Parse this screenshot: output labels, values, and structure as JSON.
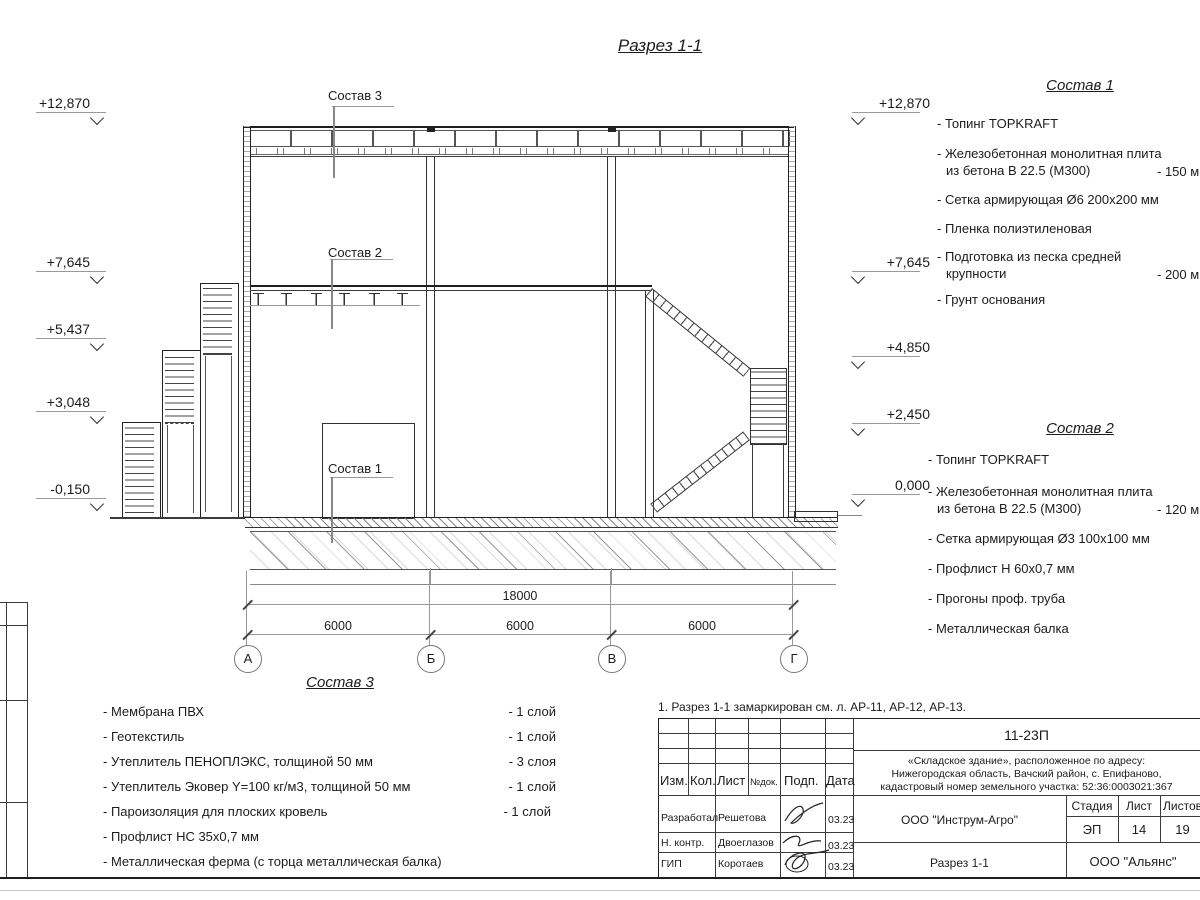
{
  "sheet": {
    "title": "Разрез 1-1",
    "note": "1. Разрез 1-1 замаркирован см. л. АР-11, АР-12, АР-13."
  },
  "elev_left": [
    {
      "value": "+12,870"
    },
    {
      "value": "+7,645"
    },
    {
      "value": "+5,437"
    },
    {
      "value": "+3,048"
    },
    {
      "value": "-0,150"
    }
  ],
  "elev_right": [
    {
      "value": "+12,870"
    },
    {
      "value": "+7,645"
    },
    {
      "value": "+4,850"
    },
    {
      "value": "+2,450"
    },
    {
      "value": "0,000"
    }
  ],
  "callouts": {
    "c1": "Состав 1",
    "c2": "Состав 2",
    "c3": "Состав 3"
  },
  "dims": {
    "total": "18000",
    "spans": [
      "6000",
      "6000",
      "6000"
    ],
    "axes": [
      "А",
      "Б",
      "В",
      "Г"
    ]
  },
  "sostav1": {
    "title": "Состав 1",
    "items": [
      {
        "text": "- Топинг TOPKRAFT"
      },
      {
        "text": "- Железобетонная  монолитная плита",
        "text2": "из бетона  В 22.5 (М300)",
        "note": "- 150 м"
      },
      {
        "text": "- Сетка армирующая Ø6 200х200 мм"
      },
      {
        "text": "- Пленка полиэтиленовая"
      },
      {
        "text": "- Подготовка из песка средней",
        "text2": "крупности",
        "note": "- 200 м"
      },
      {
        "text": "- Грунт основания"
      }
    ]
  },
  "sostav2": {
    "title": "Состав 2",
    "items": [
      {
        "text": "- Топинг TOPKRAFT"
      },
      {
        "text": "- Железобетонная  монолитная плита",
        "text2": "из бетона  В 22.5 (М300)",
        "note": "- 120 м"
      },
      {
        "text": "- Сетка армирующая Ø3 100х100 мм"
      },
      {
        "text": "- Профлист Н 60х0,7 мм"
      },
      {
        "text": "- Прогоны проф. труба"
      },
      {
        "text": "- Металлическая балка"
      }
    ]
  },
  "sostav3": {
    "title": "Состав 3",
    "items": [
      {
        "text": "- Мембрана ПВХ",
        "note": "- 1 слой"
      },
      {
        "text": "- Геотекстиль",
        "note": "- 1 слой"
      },
      {
        "text": "- Утеплитель ПЕНОПЛЭКС, толщиной 50 мм",
        "note": "- 3 слоя"
      },
      {
        "text": "- Утеплитель Эковер Y=100 кг/м3, толщиной 50 мм",
        "note": "- 1 слой"
      },
      {
        "text": "- Пароизоляция для плоских кровель",
        "note": "- 1 слой"
      },
      {
        "text": "- Профлист НС 35х0,7 мм",
        "note": ""
      },
      {
        "text": "- Металлическая ферма (с торца металлическая балка)",
        "note": ""
      }
    ]
  },
  "titleblock": {
    "doc_number": "11-23П",
    "address_line1": "«Складское здание», расположенное по адресу:",
    "address_line2": "Нижегородская область, Вачский район, с. Епифаново,",
    "address_line3": "кадастровый номер земельного участка: 52:36:0003021:367",
    "cols": {
      "izm": "Изм.",
      "kol": "Кол.",
      "list": "Лист",
      "ndok": "№док.",
      "podp": "Подп.",
      "data": "Дата"
    },
    "rows": [
      {
        "role": "Разработал",
        "name": "Решетова",
        "date": "03.23"
      },
      {
        "role": "Н. контр.",
        "name": "Двоеглазов",
        "date": "03.23"
      },
      {
        "role": "ГИП",
        "name": "Коротаев",
        "date": "03.23"
      }
    ],
    "org": "ООО \"Инструм-Агро\"",
    "stage_label": "Стадия",
    "sheet_label": "Лист",
    "sheets_label": "Листов",
    "stage": "ЭП",
    "sheet_no": "14",
    "sheets_total": "19",
    "drawing_name": "Разрез 1-1",
    "company": "ООО \"Альянс\""
  }
}
